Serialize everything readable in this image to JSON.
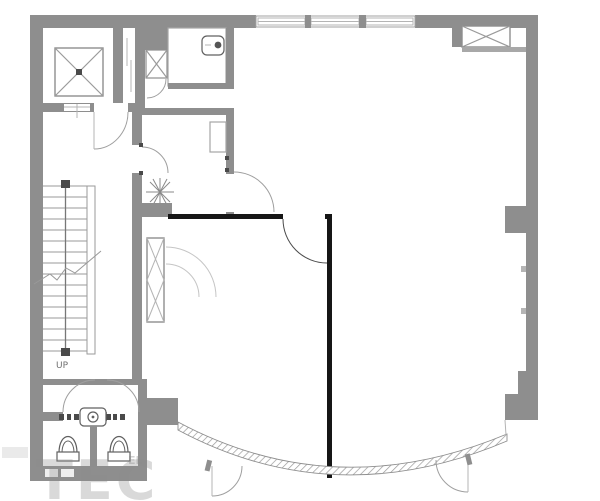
{
  "labels": {
    "stair_direction": "UP"
  },
  "watermark": {
    "text": "TEC",
    "fragment": "EL"
  },
  "symbols": {
    "elevator_car": "x-crossed-square",
    "duct_shaft": "x-braced-rect",
    "vent_box": "x-crossed-box",
    "plant": "radial-star",
    "toilet": "bowl-with-tank",
    "basin": "rounded-square-with-circle",
    "stairs": "treads-with-center-rail",
    "curtain_wall": "hatched-curved-band"
  },
  "theme": {
    "wall": "#8e8e8e",
    "wall_light": "#a8a8a8",
    "line": "#9a9a9a",
    "thin": "#b4b4b4",
    "bold": "#161616",
    "fixture": "#606060",
    "bg": "#ffffff",
    "watermark": "#8c8c8c"
  }
}
